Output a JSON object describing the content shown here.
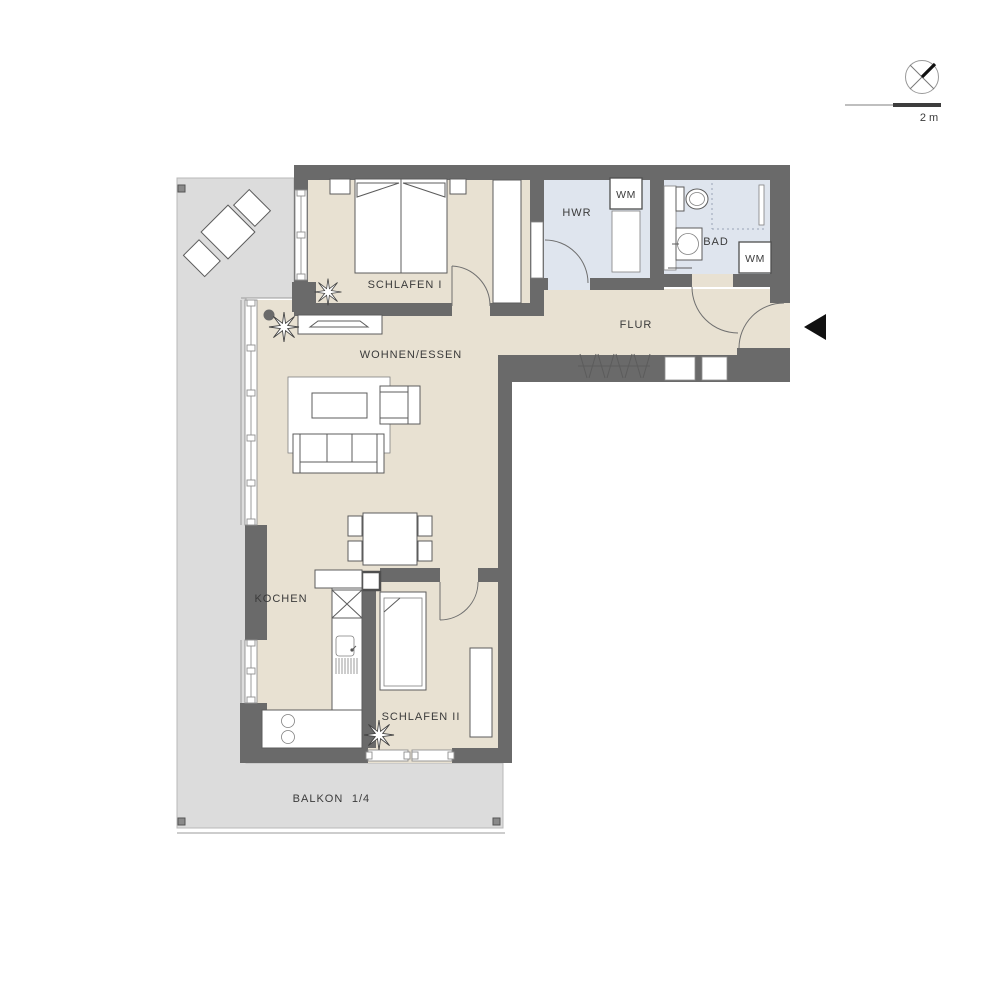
{
  "plan": {
    "type": "apartment-floor-plan",
    "colors": {
      "wall": "#6a6a6a",
      "room_floor": "#e8e1d2",
      "wet_room_floor": "#dfe5ee",
      "balcony": "#dcdcdc",
      "furniture_stroke": "#5c5c5c",
      "label_text": "#3b3b3b"
    },
    "rooms": {
      "schlafen1": {
        "label": "SCHLAFEN I"
      },
      "hwr": {
        "label": "HWR",
        "appliance": "WM"
      },
      "bad": {
        "label": "BAD",
        "appliance": "WM"
      },
      "flur": {
        "label": "FLUR"
      },
      "wohnen_essen": {
        "label": "WOHNEN/ESSEN"
      },
      "kochen": {
        "label": "KOCHEN"
      },
      "schlafen2": {
        "label": "SCHLAFEN II"
      },
      "balkon": {
        "label": "BALKON",
        "share_note": "1/4"
      }
    },
    "scale_bar": {
      "label": "2 m"
    }
  }
}
